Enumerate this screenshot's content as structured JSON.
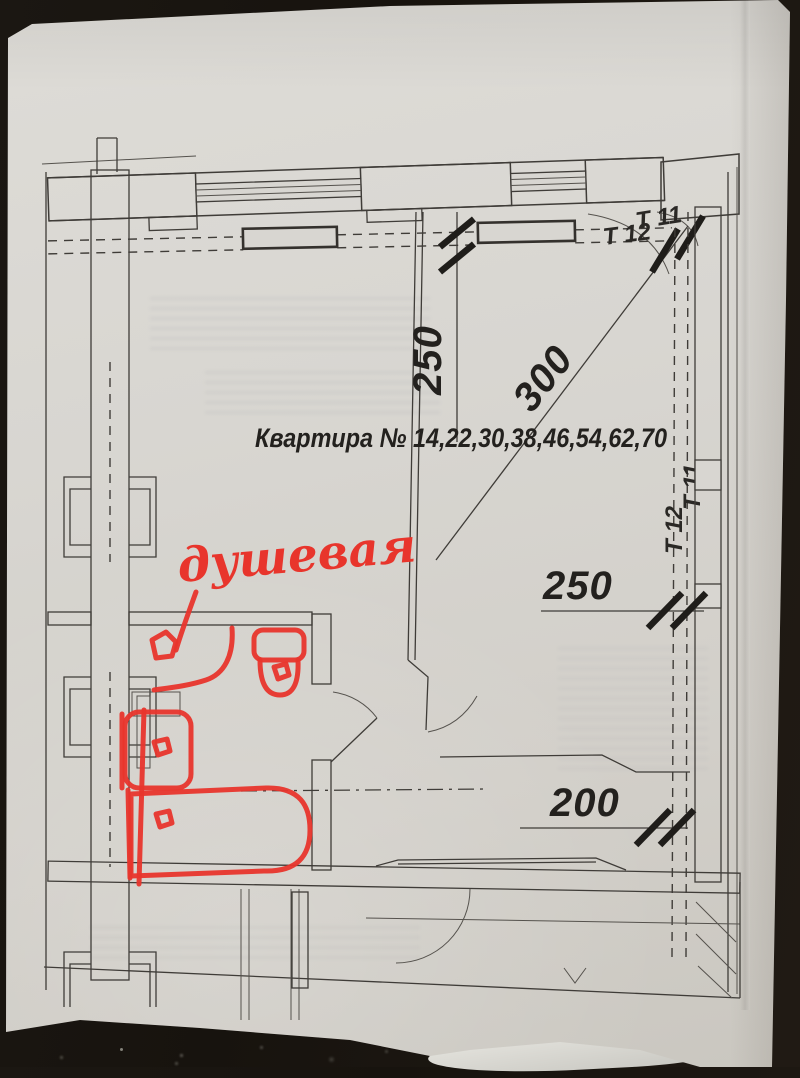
{
  "photo": {
    "background_color": "#17130e",
    "paper_color": "#d8d6d1",
    "ink_color": "#3f3c38",
    "red_annotation_color": "#e8352c"
  },
  "plan": {
    "apartment_label": "Квартира № 14,22,30,38,46,54,62,70",
    "dims": {
      "top_vertical": "250",
      "diagonal": "300",
      "right_wall": "250",
      "bottom": "200"
    },
    "risers": {
      "top_t12": "Т 12",
      "top_t11": "Т 11",
      "side_t12": "Т 12",
      "side_t11": "Т 11"
    },
    "annotation": {
      "text": "душевая"
    }
  }
}
